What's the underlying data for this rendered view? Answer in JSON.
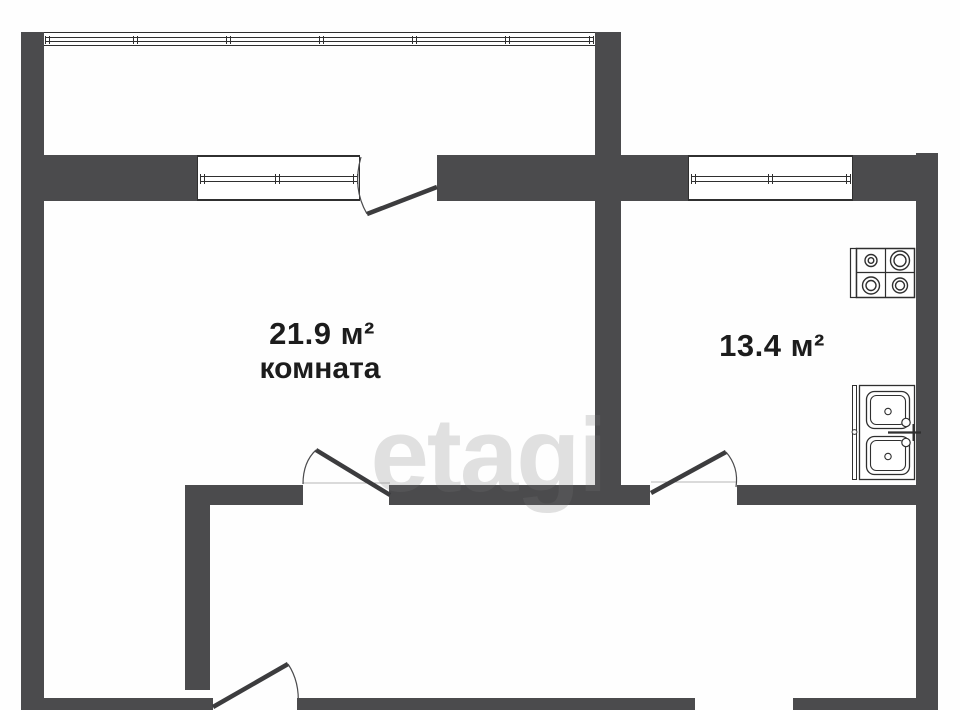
{
  "floorplan": {
    "room": {
      "area": "21.9 м²",
      "name": "комната"
    },
    "kitchen": {
      "area": "13.4 м²"
    },
    "watermark": {
      "text": "etagi"
    },
    "colors": {
      "wall": "#4b4b4d",
      "outline": "#2f2f2f",
      "background": "#ffffff",
      "label_text": "#1c1c1c",
      "watermark_gray": "#787878"
    },
    "fixtures": [
      {
        "icon": "stove-icon",
        "location": "kitchen"
      },
      {
        "icon": "sink-icon",
        "location": "kitchen"
      }
    ]
  }
}
